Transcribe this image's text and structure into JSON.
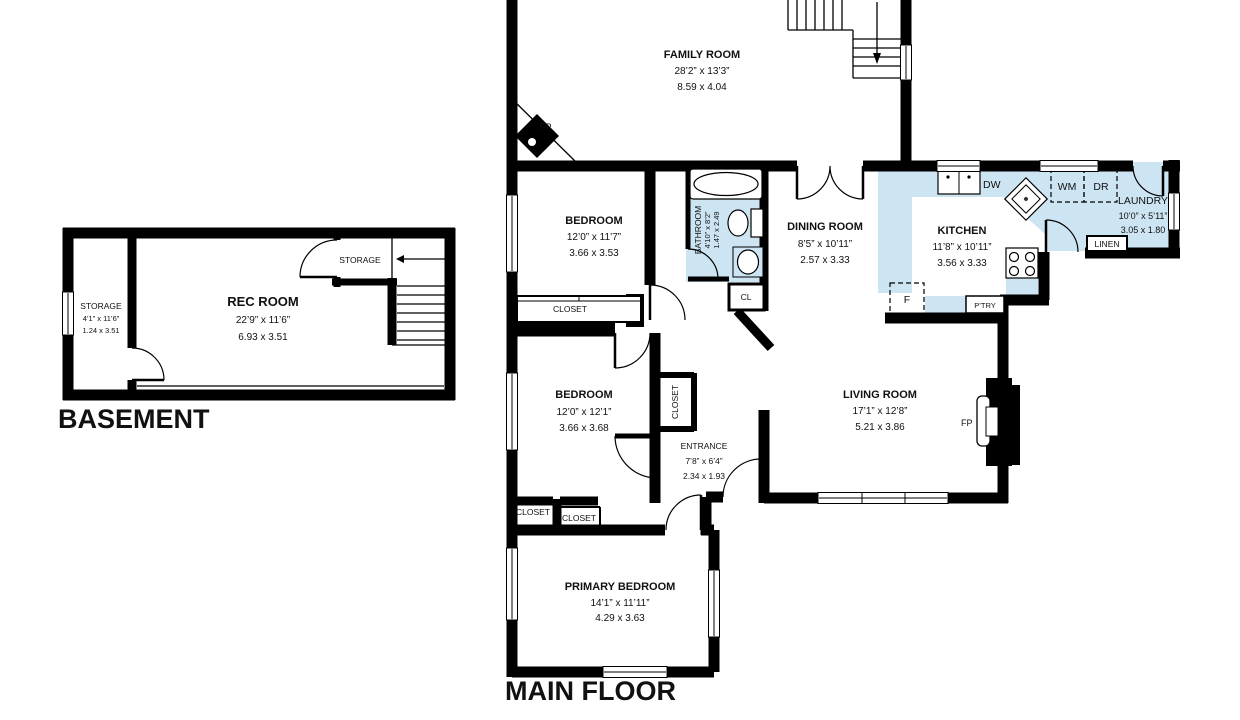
{
  "colors": {
    "wall": "#000000",
    "fixture_fill": "#cde5f3",
    "text": "#111111",
    "background": "#ffffff"
  },
  "floors": {
    "basement": {
      "title": "BASEMENT",
      "rooms": {
        "rec_room": {
          "name": "REC ROOM",
          "dims_ft": "22’9” x 11’6”",
          "dims_m": "6.93 x 3.51"
        },
        "storage": {
          "name": "STORAGE",
          "dims_ft": "4’1” x 11’6”",
          "dims_m": "1.24 x 3.51"
        },
        "storage_upper": {
          "name": "STORAGE"
        }
      }
    },
    "main_floor": {
      "title": "MAIN FLOOR",
      "rooms": {
        "family_room": {
          "name": "FAMILY ROOM",
          "dims_ft": "28’2” x 13’3”",
          "dims_m": "8.59 x 4.04"
        },
        "bedroom_top": {
          "name": "BEDROOM",
          "dims_ft": "12’0” x 11’7”",
          "dims_m": "3.66 x 3.53"
        },
        "bathroom": {
          "name": "BATHROOM",
          "dims_ft": "4’10” x 8’2”",
          "dims_m": "1.47 x 2.49"
        },
        "dining_room": {
          "name": "DINING ROOM",
          "dims_ft": "8’5” x 10’11”",
          "dims_m": "2.57 x 3.33"
        },
        "kitchen": {
          "name": "KITCHEN",
          "dims_ft": "11’8” x 10’11”",
          "dims_m": "3.56 x 3.33"
        },
        "laundry": {
          "name": "LAUNDRY",
          "dims_ft": "10’0” x 5’11”",
          "dims_m": "3.05 x 1.80"
        },
        "bedroom_middle": {
          "name": "BEDROOM",
          "dims_ft": "12’0” x 12’1”",
          "dims_m": "3.66 x 3.68"
        },
        "entrance": {
          "name": "ENTRANCE",
          "dims_ft": "7’8” x 6’4”",
          "dims_m": "2.34 x 1.93"
        },
        "living_room": {
          "name": "LIVING ROOM",
          "dims_ft": "17’1” x 12’8”",
          "dims_m": "5.21 x 3.86"
        },
        "primary_bedroom": {
          "name": "PRIMARY BEDROOM",
          "dims_ft": "14’1” x 11’11”",
          "dims_m": "4.29 x 3.63"
        }
      },
      "labels": {
        "fireplace": "FP",
        "dishwasher": "DW",
        "washer": "WM",
        "dryer": "DR",
        "fridge": "F",
        "pantry": "P’TRY",
        "linen": "LINEN",
        "small_closet": "CL",
        "closet": "CLOSET"
      }
    }
  }
}
